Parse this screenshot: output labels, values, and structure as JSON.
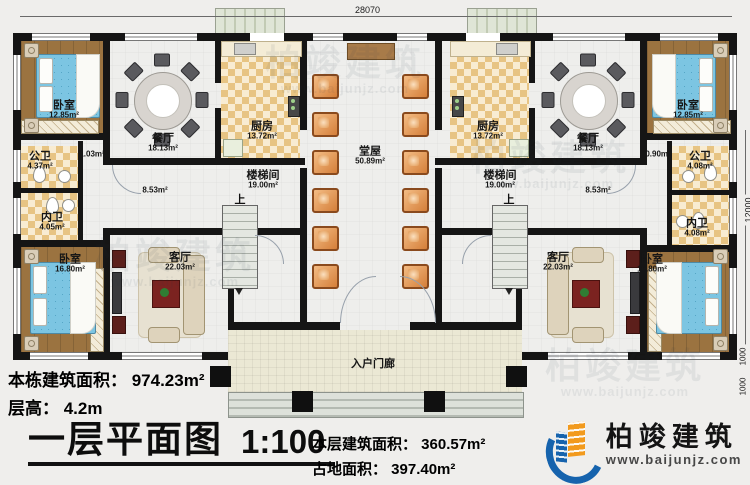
{
  "dims": {
    "top": "28070",
    "right": "12000",
    "right_b1": "1000",
    "right_b2": "1000"
  },
  "plan": {
    "up_left": "上",
    "up_right": "上",
    "corr_left_small": "1.03m²",
    "corr_right_small": "0.90m²",
    "corr_left": "8.53m²",
    "corr_right": "8.53m²",
    "rooms": {
      "bedroom_tl": {
        "name": "卧室",
        "area": "12.85m²"
      },
      "bedroom_tr": {
        "name": "卧室",
        "area": "12.85m²"
      },
      "bedroom_bl": {
        "name": "卧室",
        "area": "16.80m²"
      },
      "bedroom_br": {
        "name": "卧室",
        "area": "16.80m²"
      },
      "dining_l": {
        "name": "餐厅",
        "area": "18.13m²"
      },
      "dining_r": {
        "name": "餐厅",
        "area": "18.13m²"
      },
      "kitchen_l": {
        "name": "厨房",
        "area": "13.72m²"
      },
      "kitchen_r": {
        "name": "厨房",
        "area": "13.72m²"
      },
      "hall": {
        "name": "堂屋",
        "area": "50.89m²"
      },
      "stair_l": {
        "name": "楼梯间",
        "area": "19.00m²"
      },
      "stair_r": {
        "name": "楼梯间",
        "area": "19.00m²"
      },
      "pub_bath_l": {
        "name": "公卫",
        "area": "4.37m²"
      },
      "pub_bath_r": {
        "name": "公卫",
        "area": "4.08m²"
      },
      "pri_bath_l": {
        "name": "内卫",
        "area": "4.05m²"
      },
      "pri_bath_r": {
        "name": "内卫",
        "area": "4.08m²"
      },
      "living_l": {
        "name": "客厅",
        "area": "22.03m²"
      },
      "living_r": {
        "name": "客厅",
        "area": "22.03m²"
      },
      "porch": {
        "name": "入户门廊"
      }
    }
  },
  "footer": {
    "stat1": "本栋建筑面积： 974.23m²",
    "stat2": "层高： 4.2m",
    "title": "一层平面图",
    "scale": "1:100",
    "stat3": "本层建筑面积： 360.57m²",
    "stat4": "占地面积： 397.40m²"
  },
  "logo": {
    "name": "柏竣建筑",
    "url": "www.baijunjz.com"
  },
  "watermark": {
    "text": "柏竣建筑",
    "url": "www.baijunjz.com"
  }
}
